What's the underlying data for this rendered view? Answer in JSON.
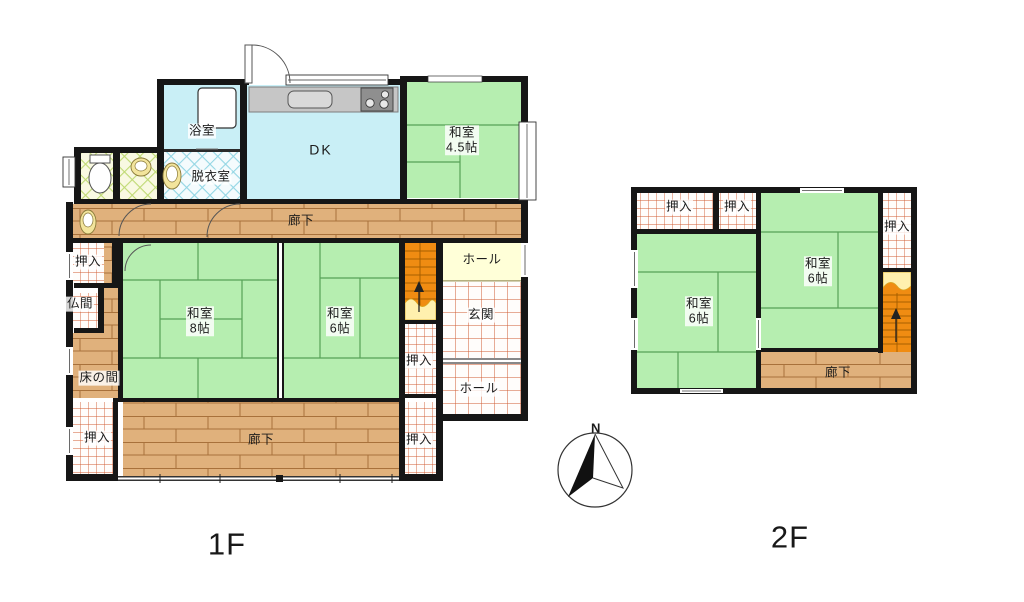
{
  "compass": {
    "north_label": "N"
  },
  "floor1": {
    "label": "1F",
    "rooms": {
      "bath": "浴室",
      "dressing": "脱衣室",
      "dk": "DK",
      "washitsu45": {
        "name": "和室",
        "size": "4.5帖"
      },
      "washitsu8": {
        "name": "和室",
        "size": "8帖"
      },
      "washitsu6": {
        "name": "和室",
        "size": "6帖"
      },
      "corridor_top": "廊下",
      "corridor_bottom": "廊下",
      "hall_upper": "ホール",
      "hall_lower": "ホール",
      "genkan": "玄関",
      "butsuma": "仏間",
      "tokonoma": "床の間",
      "closet_top_left": "押入",
      "closet_bottom_left": "押入",
      "closet_mid_right": "押入",
      "closet_bottom_right": "押入"
    }
  },
  "floor2": {
    "label": "2F",
    "rooms": {
      "closet_left": "押入",
      "closet_center": "押入",
      "closet_right": "押入",
      "washitsu6_left": {
        "name": "和室",
        "size": "6帖"
      },
      "washitsu6_right": {
        "name": "和室",
        "size": "6帖"
      },
      "corridor": "廊下"
    }
  },
  "colors": {
    "tatami_green": "#b6eeb0",
    "water_cyan": "#c9eff6",
    "wood_floor": "#e0b17c",
    "stairs_orange": "#f08c12",
    "hall_yellow": "#ffffd8",
    "grid_red": "#d05c32",
    "wall_black": "#161616"
  }
}
